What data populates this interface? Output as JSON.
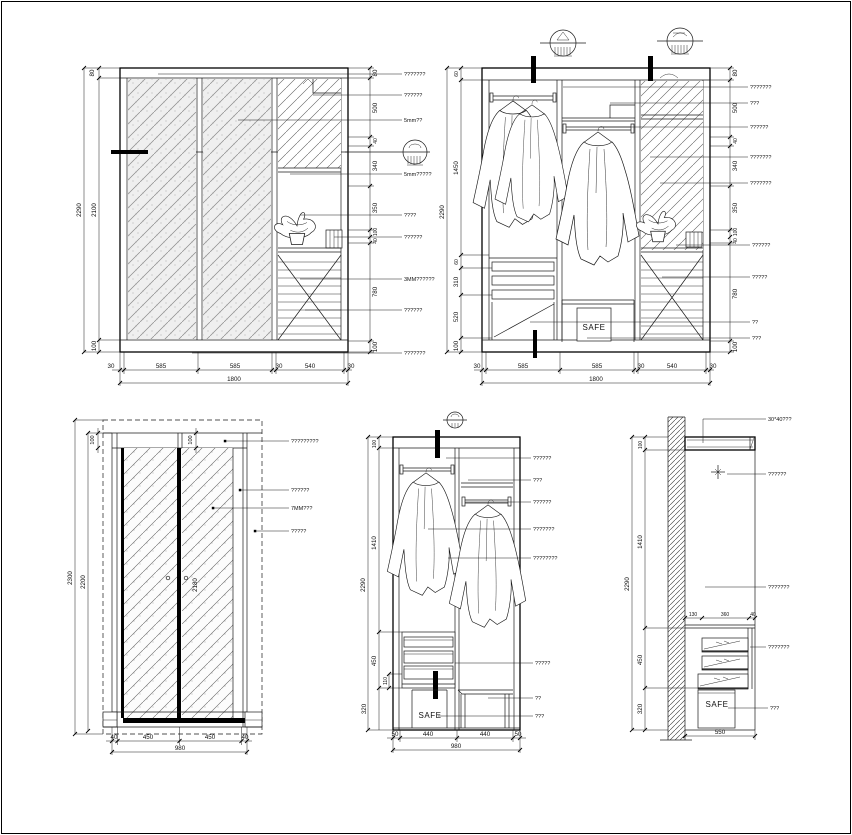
{
  "sheet": {
    "background": "#ffffff",
    "line_color": "#1a1a1a"
  },
  "dA": {
    "left": [
      "80",
      "2290",
      "2100",
      "100"
    ],
    "right": [
      "80",
      "500",
      "40",
      "340",
      "350",
      "100",
      "40",
      "780",
      "100"
    ],
    "notes": [
      "???????",
      "??????",
      "5mm??",
      "5mm?????",
      "????",
      "??????",
      "3MM??????",
      "??????",
      "???????"
    ],
    "bottom": [
      "30",
      "585",
      "585",
      "30",
      "540",
      "30"
    ],
    "total": "1800"
  },
  "dB": {
    "left": [
      "60",
      "1450",
      "2290",
      "60",
      "310",
      "520",
      "100"
    ],
    "right": [
      "80",
      "500",
      "40",
      "340",
      "350",
      "100",
      "40",
      "780",
      "100"
    ],
    "notes": [
      "???????",
      "???",
      "??????",
      "???????",
      "???????",
      "??????",
      "?????",
      "??",
      "???"
    ],
    "bottom": [
      "30",
      "585",
      "585",
      "30",
      "540",
      "30"
    ],
    "total": "1800",
    "safe": "SAFE"
  },
  "dC": {
    "top": [
      "100",
      "100"
    ],
    "left": [
      "2300",
      "2200"
    ],
    "inner": "2180",
    "notes": [
      "?????????",
      "??????",
      "7MM???",
      "?????"
    ],
    "bottom": [
      "40",
      "450",
      "450",
      "40"
    ],
    "total": "980"
  },
  "dD": {
    "left": [
      "100",
      "1410",
      "2290",
      "450",
      "110",
      "320"
    ],
    "notes": [
      "??????",
      "???",
      "??????",
      "???????",
      "????????",
      "?????",
      "??",
      "???"
    ],
    "bottom": [
      "50",
      "440",
      "440",
      "50"
    ],
    "total": "980",
    "safe": "SAFE"
  },
  "dE": {
    "left": [
      "100",
      "1410",
      "2290",
      "450",
      "320"
    ],
    "top": [
      "130",
      "360",
      "40"
    ],
    "notes": [
      "30*40???",
      "??????",
      "???????",
      "???????",
      "???"
    ],
    "bottom": "550",
    "safe": "SAFE"
  }
}
